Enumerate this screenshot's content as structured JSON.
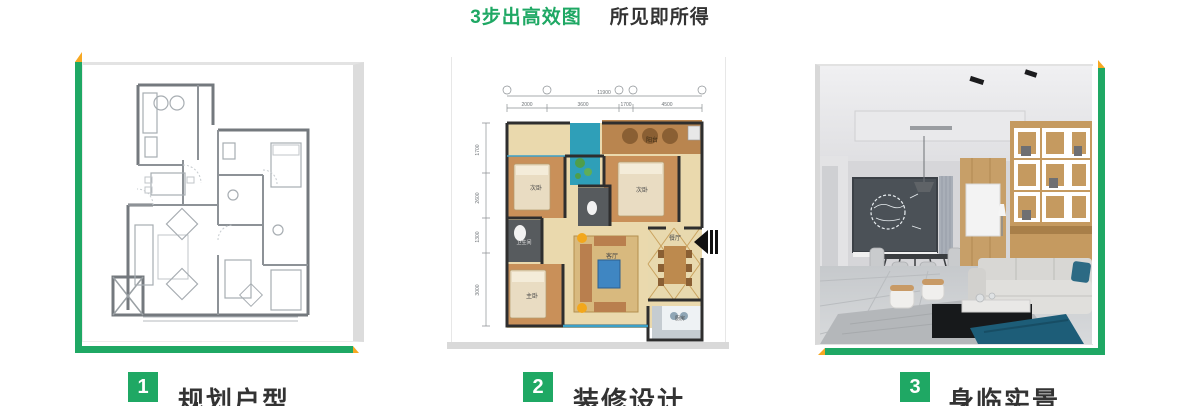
{
  "colors": {
    "green": "#1fa864",
    "yellow": "#f7a823",
    "text_dark": "#333333"
  },
  "title": {
    "highlight": "3步出高效图",
    "rest": "所见即所得"
  },
  "steps": [
    {
      "number": "1",
      "label": "规划户型"
    },
    {
      "number": "2",
      "label": "装修设计"
    },
    {
      "number": "3",
      "label": "身临实景"
    }
  ],
  "panel1": {
    "content": "黑白CAD户型图"
  },
  "panel2": {
    "dim_total": "11900",
    "dims_top": [
      "2000",
      "3600",
      "1700",
      "4500"
    ],
    "dims_left": [
      "1700",
      "2600",
      "1300",
      "3000"
    ],
    "rooms": {
      "balcony": "阳台",
      "bedroom2a": "次卧",
      "bedroom2b": "次卧",
      "master": "主卧",
      "living": "客厅",
      "dining": "餐厅",
      "kitchen": "厨房",
      "bath": "卫生间"
    }
  },
  "panel3": {
    "content": "客厅实景渲染图"
  }
}
